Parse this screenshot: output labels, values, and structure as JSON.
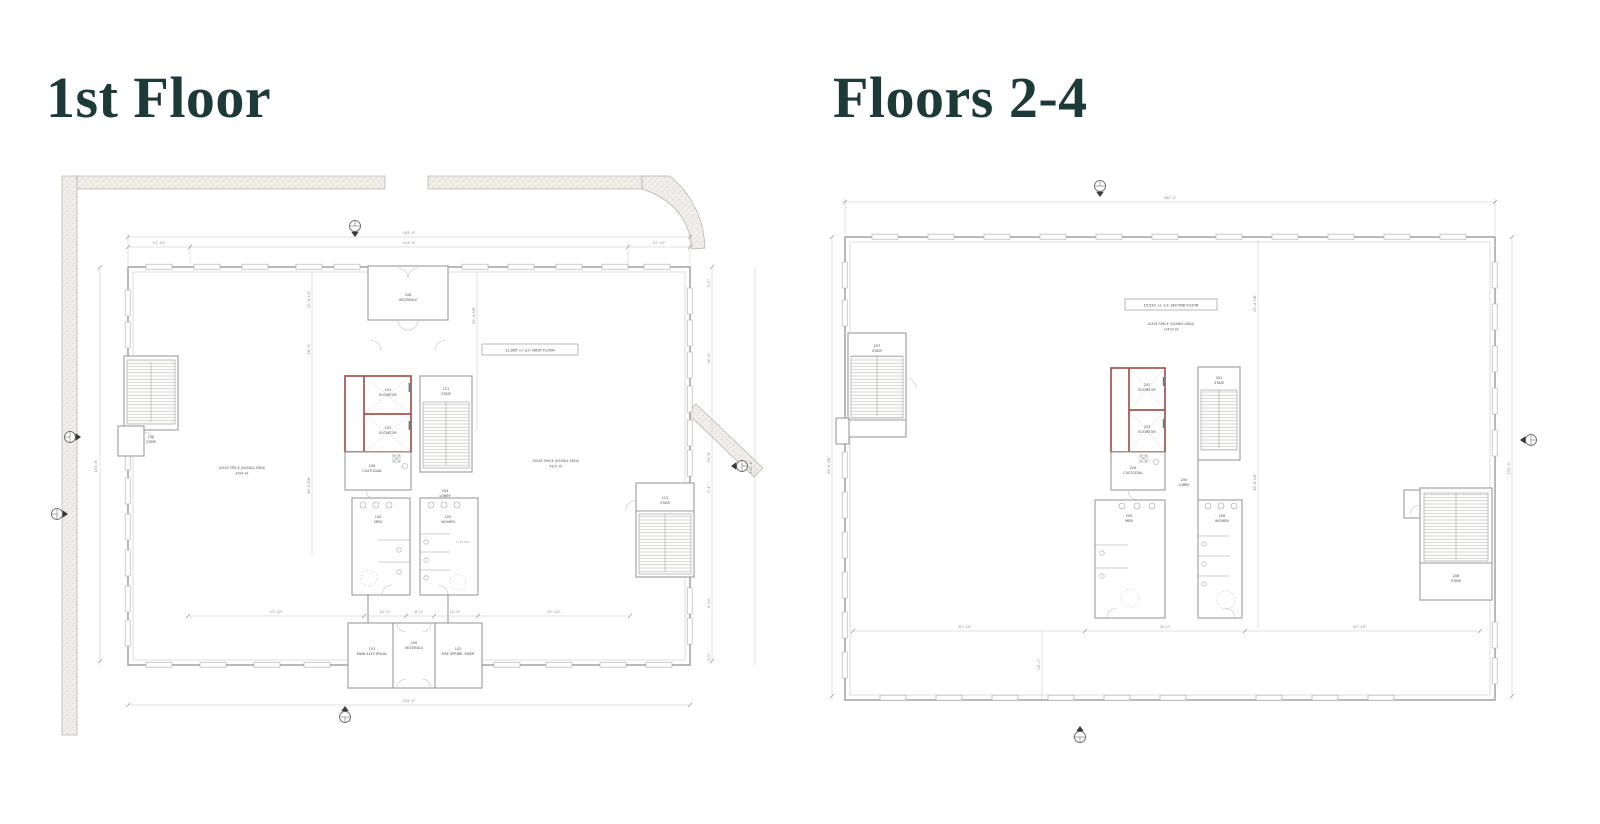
{
  "titles": {
    "left": "1st Floor",
    "right": "Floors 2-4"
  },
  "plan1": {
    "areaBox": "11,065 +/- S.F. FIRST FLOOR",
    "leaseL1": "LEASE SPACE (USABLE AREA)",
    "leaseL2": "4094 SF",
    "leaseR1": "LEASE SPACE (USABLE AREA)",
    "leaseR2": "6101 SF",
    "rooms": {
      "vestTopNum": "108",
      "vestTopName": "VESTIBULE",
      "elev1Num": "102",
      "elev1Name": "ELEVATOR",
      "elev2Num": "103",
      "elev2Name": "ELEVATOR",
      "stairCNum": "121",
      "stairCName": "STAIR",
      "custNum": "106",
      "custName": "CUSTODIAL",
      "lobbyNum": "103",
      "lobbyName": "LOBBY",
      "menNum": "104",
      "menName": "MEN",
      "womenNum": "105",
      "womenName": "WOMEN",
      "stairLNum": "110",
      "stairLName": "STAIR",
      "stairRNum": "112",
      "stairRName": "STAIR",
      "elecNum": "101",
      "elecName": "MAIN ELECTRICAL",
      "vestBNum": "100",
      "vestBName": "VESTIBULE",
      "fireNum": "102",
      "fireName": "FIRE SPRINK. RISER"
    },
    "dims": {
      "topOverall": "163'-0\"",
      "topL": "17'-10\"",
      "topC": "114'-4\"",
      "topR": "17'-10\"",
      "leftOverall": "103'-8\"",
      "int1": "12'-4 1/2\"",
      "int2": "14'-6\"",
      "int3": "98'-0 5/8\"",
      "int4": "29'-4 3/8\"",
      "r1": "3'-0\"",
      "r2": "40'-4\"",
      "r3": "16'-8\"",
      "r4": "7'-4\"",
      "r5": "4'-10\"",
      "r6": "3'-0\"",
      "farRight": "105'-8\"",
      "b1": "57'-10\"",
      "b2": "12'-0\"",
      "b3": "8'-0\"",
      "b4": "12'-0\"",
      "b5": "57'-10\"",
      "bottomOverall": "103'-0\"",
      "women": "7'-11 3/4\""
    }
  },
  "plan2": {
    "areaBox": "15,533 +/- S.F. SECOND FLOOR",
    "lease1": "LEASE SPACE (USABLE AREA)",
    "lease2": "13429 SF",
    "rooms": {
      "stairTLNum": "207",
      "stairTLName": "STAIR",
      "elev1Num": "202",
      "elev1Name": "ELEVATOR",
      "elev2Num": "203",
      "elev2Name": "ELEVATOR",
      "stairCNum": "201",
      "stairCName": "STAIR",
      "custNum": "204",
      "custName": "CUSTODIAL",
      "lobbyNum": "200",
      "lobbyName": "LOBBY",
      "menNum": "205",
      "menName": "MEN",
      "womenNum": "206",
      "womenName": "WOMEN",
      "stairBRNum": "208",
      "stairBRName": "STAIR"
    },
    "dims": {
      "top": "182'-0\"",
      "right1": "29'-4 3/8\"",
      "right2": "58'-8 3/8\"",
      "farRight": "110'-0\"",
      "left1": "58'-8 3/8\"",
      "left2": "22'-7\"",
      "b1": "67'-10\"",
      "b2": "32'-0\"",
      "b3": "67'-10\""
    }
  }
}
